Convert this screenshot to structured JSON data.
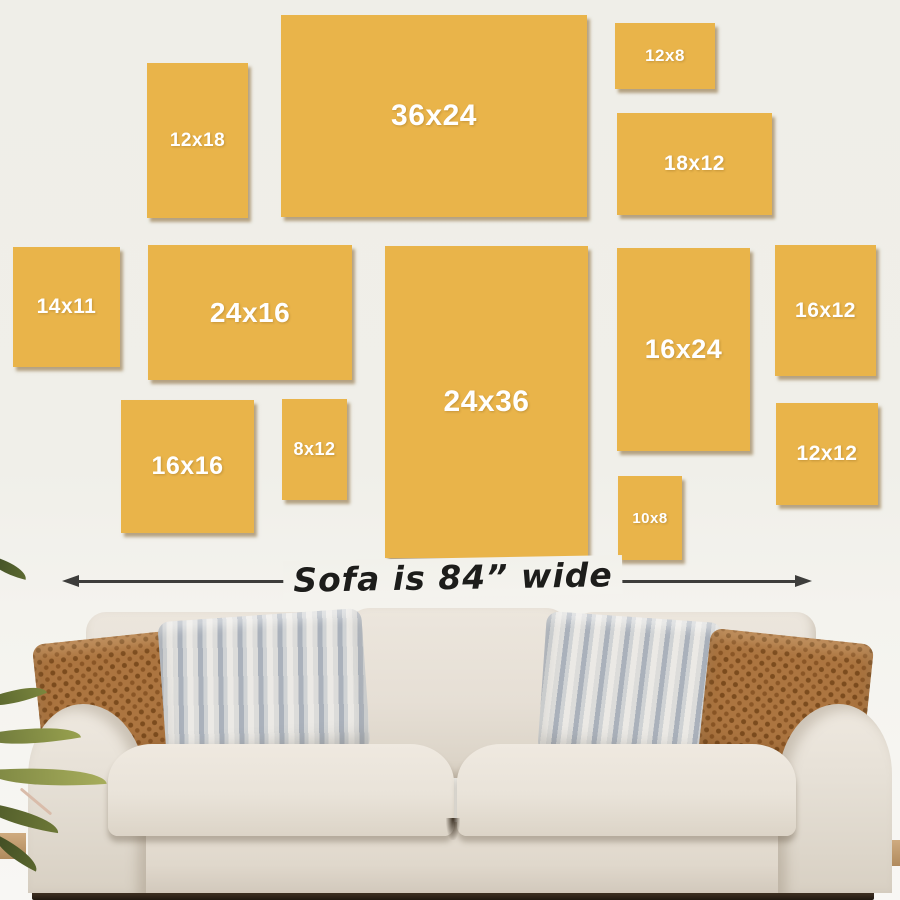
{
  "measure": {
    "label": "Sofa is 84” wide",
    "left_arrowhead_icon": "left-arrowhead",
    "right_arrowhead_icon": "right-arrowhead"
  },
  "panels": [
    {
      "label": "36x24",
      "left": 281,
      "top": 15,
      "width": 306,
      "height": 202,
      "font": 30
    },
    {
      "label": "12x18",
      "left": 147,
      "top": 63,
      "width": 101,
      "height": 155,
      "font": 19
    },
    {
      "label": "12x8",
      "left": 615,
      "top": 23,
      "width": 100,
      "height": 66,
      "font": 17
    },
    {
      "label": "18x12",
      "left": 617,
      "top": 113,
      "width": 155,
      "height": 102,
      "font": 21
    },
    {
      "label": "14x11",
      "left": 13,
      "top": 247,
      "width": 107,
      "height": 120,
      "font": 21
    },
    {
      "label": "24x16",
      "left": 148,
      "top": 245,
      "width": 204,
      "height": 135,
      "font": 28
    },
    {
      "label": "24x36",
      "left": 385,
      "top": 246,
      "width": 203,
      "height": 312,
      "font": 30
    },
    {
      "label": "16x24",
      "left": 617,
      "top": 248,
      "width": 133,
      "height": 203,
      "font": 27
    },
    {
      "label": "16x12",
      "left": 775,
      "top": 245,
      "width": 101,
      "height": 131,
      "font": 21
    },
    {
      "label": "16x16",
      "left": 121,
      "top": 400,
      "width": 133,
      "height": 133,
      "font": 25
    },
    {
      "label": "8x12",
      "left": 282,
      "top": 399,
      "width": 65,
      "height": 101,
      "font": 18
    },
    {
      "label": "12x12",
      "left": 776,
      "top": 403,
      "width": 102,
      "height": 102,
      "font": 21
    },
    {
      "label": "10x8",
      "left": 618,
      "top": 476,
      "width": 64,
      "height": 84,
      "font": 15
    }
  ],
  "colors": {
    "panel": "#e9b44a",
    "panel_shadow": "rgba(122,86,28,0.5)",
    "wall": "#efeee8",
    "arrow": "#3d3d3b",
    "sofa_fabric": "#e8e2d8",
    "pillow_brown": "#ac7540",
    "pillow_stripe_gray": "#aab1bb",
    "plant_green": "#6d7839",
    "floor_shadow": "#2e241a"
  }
}
